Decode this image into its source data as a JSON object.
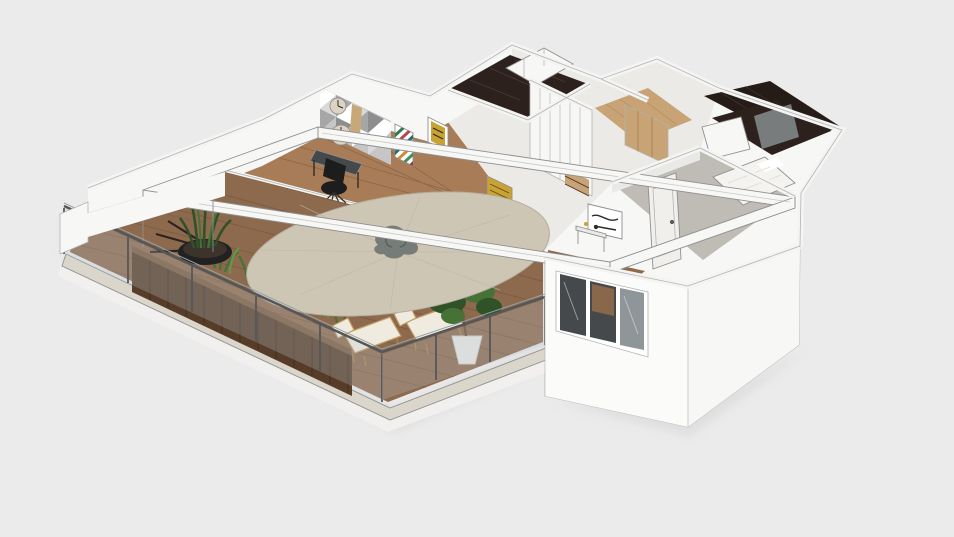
{
  "meta": {
    "description": "3D isometric render of an apartment floor plan with a furnished wooden-deck terrace, glass railings, round parasol, white walls, wardrobes, dark marble bathrooms and a bedroom",
    "view": "axonometric 3d floorplan render",
    "app_chrome": "none"
  },
  "scene": {
    "background": "#ebebeb",
    "objects": [
      "white perimeter walls",
      "terrace wooden deck",
      "glass railing with metal posts",
      "dark wood planter wall",
      "planter greenery",
      "snake plant in black pot",
      "round beige parasol table",
      "white pergola beams",
      "lounge chairs",
      "potted tree",
      "black round coffee table",
      "decorative dry branch",
      "sliding glass doors",
      "deck stairs",
      "stair glass balustrade",
      "desk with office chair",
      "triangle mosaic accent wall",
      "round wall clocks",
      "chevron stripe artwork",
      "gold framed art",
      "white wardrobe closet",
      "hallway wood floor",
      "dark marble bathroom",
      "glass shower panel",
      "white vanity cabinet",
      "bedroom gray floor",
      "white bed",
      "interior white door",
      "three-pane window",
      "sheer curtain",
      "console with decor",
      "black-and-white wall art"
    ],
    "palette": {
      "bg": "#ebebeb",
      "shadow": "#d5d5d5",
      "wallWhite": "#f7f7f6",
      "wallBright": "#fbfbfa",
      "wallShade": "#e9e9e8",
      "wallTop": "#f4f4f3",
      "outline": "#b3b3b3",
      "outlineDark": "#8f8f8f",
      "interiorFloor": "#eceae6",
      "deckWood": "#8d6a4d",
      "deckLine": "#74553c",
      "plankDark": "#573d29",
      "plankLine": "#3f2c1d",
      "plankHi": "#7a593c",
      "gravel": "#dbd6cb",
      "slabWhite": "#f1f0ee",
      "glassRail": "#b9c6cc",
      "railMetal": "#53575a",
      "railLight": "#9aa0a3",
      "umbrella": "#cec6b5",
      "umbrellaEdge": "#b6ae9d",
      "umbrellaLine": "#beb6a4",
      "ornament": "#767c77",
      "ornamentDark": "#596058",
      "tableBlack": "#1d1d1d",
      "gold": "#c9a232",
      "cushion": "#f0ebdf",
      "chairWood": "#bf9a63",
      "chairWoodDark": "#a57f4b",
      "plantDark": "#2f5229",
      "plantMid": "#477237",
      "plantLight": "#629a48",
      "potWhite": "#e9e7e3",
      "potShade": "#cfccc7",
      "potBlack": "#212121",
      "trunk": "#6b4a33",
      "floorWoodA": "#a87c57",
      "floorWoodB": "#c7a376",
      "floorWoodC": "#8f6a4a",
      "marbleDark": "#251b17",
      "marbleFloor": "#2c211c",
      "marbleVein": "#6a5f58",
      "glassDark": "#45494c",
      "glassMid": "#8e9699",
      "frameWhite": "#eeeeee",
      "curtain": "#f7f6f3",
      "curtainFold": "#e3e1dc",
      "bedWhite": "#f5f3ef",
      "grayFloor": "#bfbbb5",
      "doorWhite": "#f1efec",
      "artFrame": "#ffffff",
      "artDark": "#2e2b28",
      "triA": "#d9d9d9",
      "triB": "#ffffff",
      "triC": "#a6a6a6",
      "triD": "#c6c6c6",
      "triE": "#8e8e8e",
      "accA": "#2f7d4f",
      "accB": "#b8434a",
      "accC": "#1f6f6b",
      "accD": "#d2883e",
      "accE": "#3f8f5c",
      "accF": "#8c3b40",
      "clockFace": "#ddd3c2",
      "woodDecor": "#c9a878"
    }
  }
}
